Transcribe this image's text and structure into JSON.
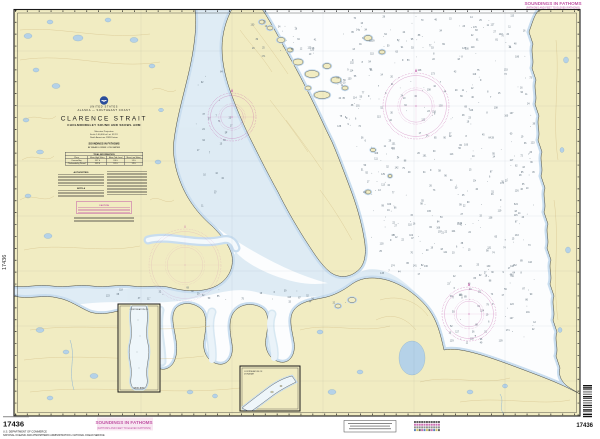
{
  "chart": {
    "number": "17436",
    "nation": "UNITED STATES",
    "region": "ALASKA — SOUTHEAST COAST",
    "title": "CLARENCE STRAIT",
    "subtitle": "CHOLMONDELEY SOUND AND SKOWL ARM",
    "projection": "Mercator Projection",
    "scale": "Scale 1:40,000 at Lat. 55°15'",
    "datum": "North American 1983 Datum",
    "soundings_line1": "SOUNDINGS IN FATHOMS",
    "soundings_line2": "AT MEAN LOWER LOW WATER"
  },
  "marginalia": {
    "soundings_note": "SOUNDINGS IN FATHOMS",
    "soundings_subnote": "(FATHOMS AND FEET TO ELEVEN FATHOMS)",
    "publisher_line1": "U.S. DEPARTMENT OF COMMERCE",
    "publisher_line2": "NATIONAL OCEANIC AND ATMOSPHERIC ADMINISTRATION  •  NATIONAL OCEAN SERVICE"
  },
  "title_block": {
    "notes": {
      "authorities": "AUTHORITIES",
      "note_a": "NOTE A",
      "caution": "CAUTION"
    },
    "tidal": {
      "title": "TIDAL INFORMATION",
      "headers": [
        "Place",
        "Mean High Water",
        "Mean Tide Level",
        "Mean Low Water"
      ],
      "rows": [
        [
          "Kasaan Bay",
          "14.7 ft",
          "8.0 ft",
          "1.3 ft"
        ],
        [
          "Cholmondeley Sound",
          "14.9 ft",
          "8.1 ft",
          "1.3 ft"
        ]
      ]
    }
  },
  "insets": {
    "a_label_1": "CONTINUATION OF",
    "a_label_2": "WEST ARM",
    "b_label_1": "CONTINUATION OF",
    "b_label_2": "DORA BAY"
  },
  "colors": {
    "land": "#f1ecc2",
    "shallow": "#d3e5f1",
    "magenta": "#c155a5",
    "water": "#fcfdfe"
  }
}
